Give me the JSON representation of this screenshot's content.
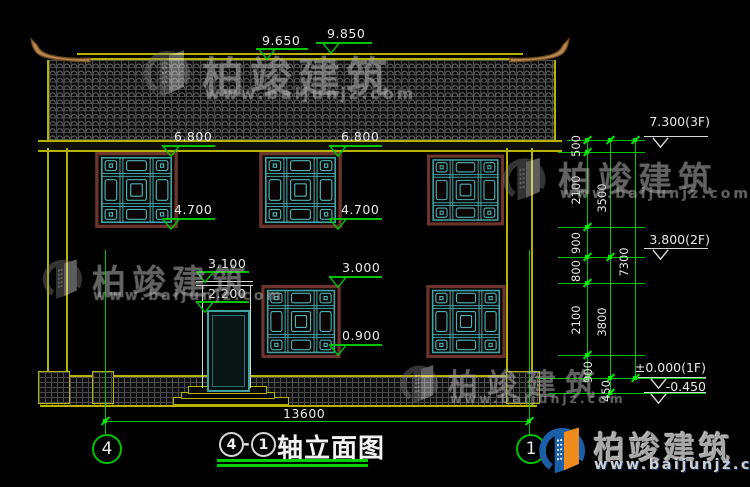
{
  "watermark": {
    "brand": "柏竣建筑",
    "site": "www.baijunjz.com"
  },
  "drawing": {
    "title": {
      "axis_start": "4",
      "dash": "-",
      "axis_end": "1",
      "name": "轴立面图"
    },
    "axis_bubbles": {
      "left": "4",
      "right": "1"
    },
    "facade_markers": [
      "9.650",
      "9.850",
      "6.800",
      "6.800",
      "4.700",
      "4.700",
      "3.100",
      "2.200",
      "3.000",
      "0.900"
    ],
    "floor_markers": [
      "7.300(3F)",
      "3.800(2F)",
      "±0.000(1F)",
      "-0.450"
    ],
    "dim_chain_inner": [
      "500",
      "2100",
      "900",
      "800",
      "2100",
      "900"
    ],
    "dim_chain_mid": [
      "3500",
      "3800",
      "450"
    ],
    "dim_chain_outer": [
      "7300"
    ],
    "overall_width": "13600"
  }
}
